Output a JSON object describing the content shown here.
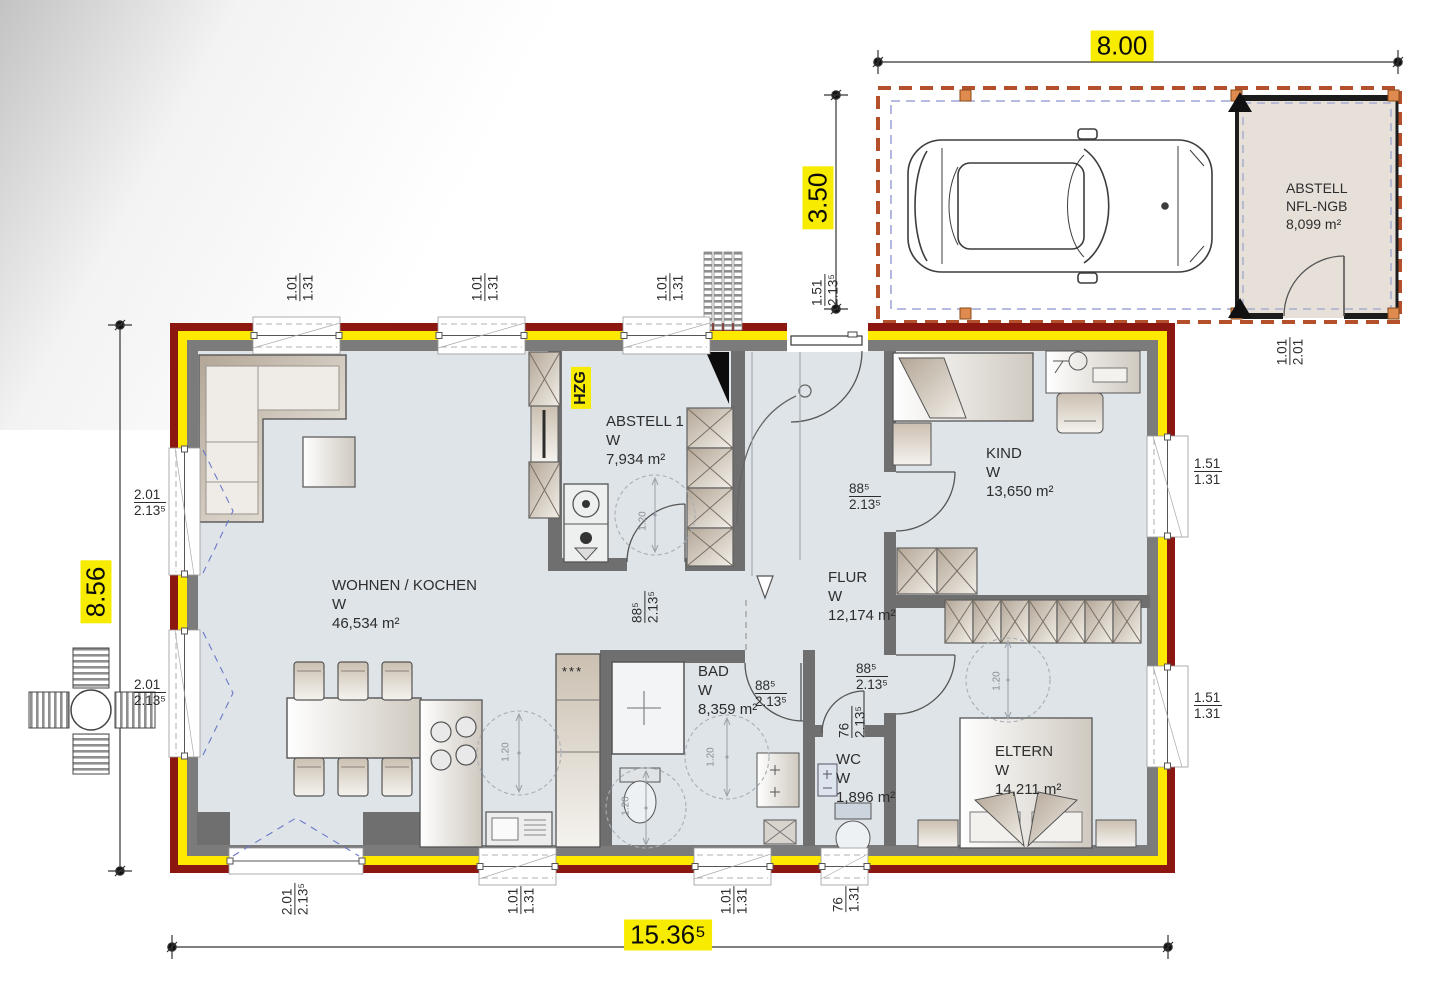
{
  "dimensions": {
    "carport_width": "8.00",
    "carport_depth": "3.50",
    "house_depth": "8.56",
    "house_width": "15.36⁵",
    "turning_circle": "1.20"
  },
  "rooms": {
    "wohnen": {
      "name": "WOHNEN / KOCHEN",
      "flag": "W",
      "area": "46,534 m²"
    },
    "abstell1": {
      "name": "ABSTELL 1",
      "flag": "W",
      "area": "7,934 m²"
    },
    "kind": {
      "name": "KIND",
      "flag": "W",
      "area": "13,650 m²"
    },
    "flur": {
      "name": "FLUR",
      "flag": "W",
      "area": "12,174 m²"
    },
    "bad": {
      "name": "BAD",
      "flag": "W",
      "area": "8,359 m²"
    },
    "wc": {
      "name": "WC",
      "flag": "W",
      "area": "1,896 m²"
    },
    "eltern": {
      "name": "ELTERN",
      "flag": "W",
      "area": "14,211 m²"
    },
    "carport_abstell": {
      "name": "ABSTELL",
      "subname": "NFL-NGB",
      "area": "8,099 m²"
    }
  },
  "tags": {
    "heating": "HZG",
    "freezer_stars": "***"
  },
  "window_labels": {
    "top": [
      {
        "w": "1.01",
        "h": "1.31"
      },
      {
        "w": "1.01",
        "h": "1.31"
      },
      {
        "w": "1.01",
        "h": "1.31"
      }
    ],
    "right": [
      {
        "w": "1.51",
        "h": "1.31"
      },
      {
        "w": "1.51",
        "h": "1.31"
      }
    ],
    "left": [
      {
        "w": "2.01",
        "h": "2.13⁵"
      },
      {
        "w": "2.01",
        "h": "2.13⁵"
      }
    ],
    "bottom": [
      {
        "w": "2.01",
        "h": "2.13⁵"
      },
      {
        "w": "1.01",
        "h": "1.31"
      },
      {
        "w": "1.01",
        "h": "1.31"
      },
      {
        "w": "76",
        "h": "1.31"
      }
    ],
    "entry": {
      "w": "1.51",
      "h": "2.13⁵"
    },
    "carport_door": {
      "w": "1.01",
      "h": "2.01"
    }
  },
  "door_labels": {
    "kind": {
      "w": "88⁵",
      "h": "2.13⁵"
    },
    "eltern": {
      "w": "88⁵",
      "h": "2.13⁵"
    },
    "bad": {
      "w": "88⁵",
      "h": "2.13⁵"
    },
    "abstell1": {
      "w": "88⁵",
      "h": "2.13⁵"
    },
    "wc": {
      "w": "76",
      "h": "2.13⁵"
    }
  }
}
